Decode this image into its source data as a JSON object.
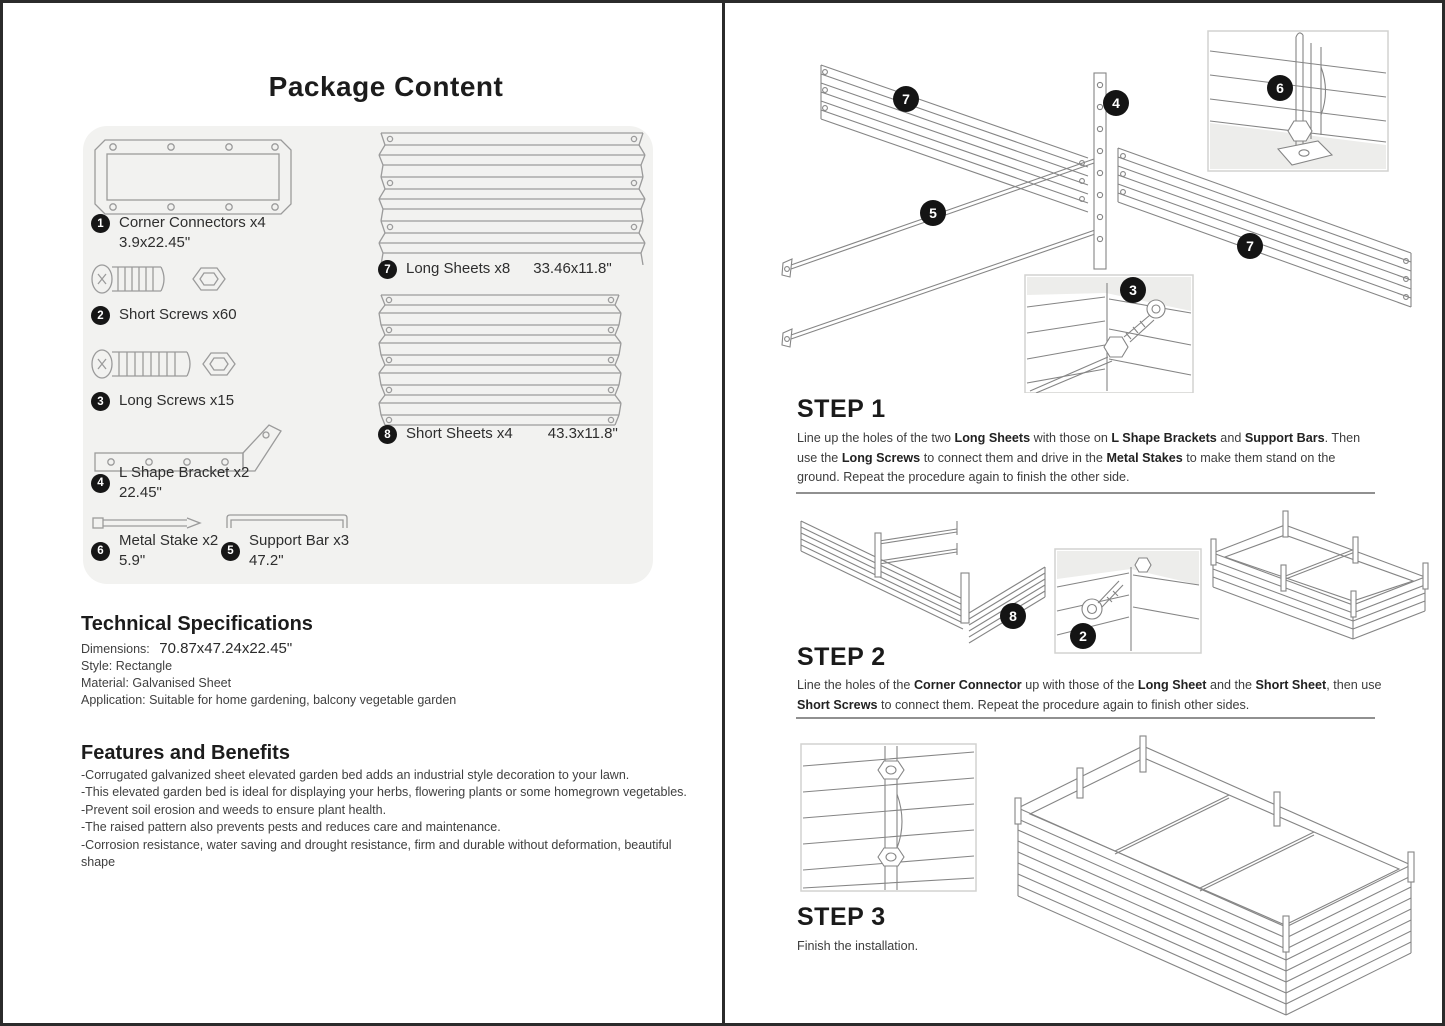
{
  "package": {
    "title": "Package Content",
    "parts": [
      {
        "num": "1",
        "label": "Corner Connectors x4",
        "dim": "3.9x22.45\""
      },
      {
        "num": "2",
        "label": "Short Screws x60",
        "dim": ""
      },
      {
        "num": "3",
        "label": "Long Screws x15",
        "dim": ""
      },
      {
        "num": "4",
        "label": "L Shape Bracket x2",
        "dim": "22.45\""
      },
      {
        "num": "6",
        "label": "Metal Stake x2",
        "dim": "5.9\""
      },
      {
        "num": "5",
        "label": "Support Bar x3",
        "dim": "47.2\""
      },
      {
        "num": "7",
        "label": "Long Sheets x8",
        "dim": "33.46x11.8\""
      },
      {
        "num": "8",
        "label": "Short Sheets x4",
        "dim": "43.3x11.8\""
      }
    ]
  },
  "specs": {
    "heading": "Technical Specifications",
    "dimensions_label": "Dimensions:",
    "dimensions_value": "70.87x47.24x22.45\"",
    "rows": [
      "Style: Rectangle",
      "Material: Galvanised Sheet",
      "Application: Suitable for home gardening, balcony vegetable garden"
    ]
  },
  "features": {
    "heading": "Features and Benefits",
    "items": [
      "-Corrugated galvanized sheet elevated garden bed adds an industrial style decoration to your lawn.",
      "-This elevated garden bed is ideal for displaying your herbs, flowering plants or some homegrown vegetables.",
      "-Prevent soil erosion and weeds to ensure plant health.",
      "-The raised pattern also prevents pests and reduces care and maintenance.",
      "-Corrosion resistance, water saving and drought resistance, firm and durable without deformation, beautiful shape"
    ]
  },
  "steps": [
    {
      "title": "STEP 1",
      "segments": [
        {
          "t": "Line up the holes of the two "
        },
        {
          "t": "Long Sheets",
          "b": true
        },
        {
          "t": " with those on "
        },
        {
          "t": "L Shape Brackets",
          "b": true
        },
        {
          "t": " and "
        },
        {
          "t": "Support Bars",
          "b": true
        },
        {
          "t": ". Then use the "
        },
        {
          "t": "Long Screws",
          "b": true
        },
        {
          "t": " to connect them and drive in the "
        },
        {
          "t": "Metal Stakes",
          "b": true
        },
        {
          "t": " to make them stand on the ground. Repeat the procedure again to finish the other side."
        }
      ]
    },
    {
      "title": "STEP 2",
      "segments": [
        {
          "t": "Line the holes of the "
        },
        {
          "t": "Corner Connector",
          "b": true
        },
        {
          "t": " up with those of the "
        },
        {
          "t": "Long Sheet",
          "b": true
        },
        {
          "t": " and the "
        },
        {
          "t": "Short Sheet",
          "b": true
        },
        {
          "t": ", then use "
        },
        {
          "t": "Short Screws",
          "b": true
        },
        {
          "t": " to connect them. Repeat the procedure again to finish other sides."
        }
      ]
    },
    {
      "title": "STEP 3",
      "segments": [
        {
          "t": "Finish the installation."
        }
      ]
    }
  ],
  "badges": {
    "step1": [
      "7",
      "4",
      "6",
      "5",
      "3",
      "7"
    ],
    "step2": [
      "8",
      "2"
    ]
  },
  "colors": {
    "panel_bg": "#f2f2f0",
    "badge_bg": "#161616",
    "line_art": "#8c8c8c",
    "border": "#2b2b2b"
  }
}
